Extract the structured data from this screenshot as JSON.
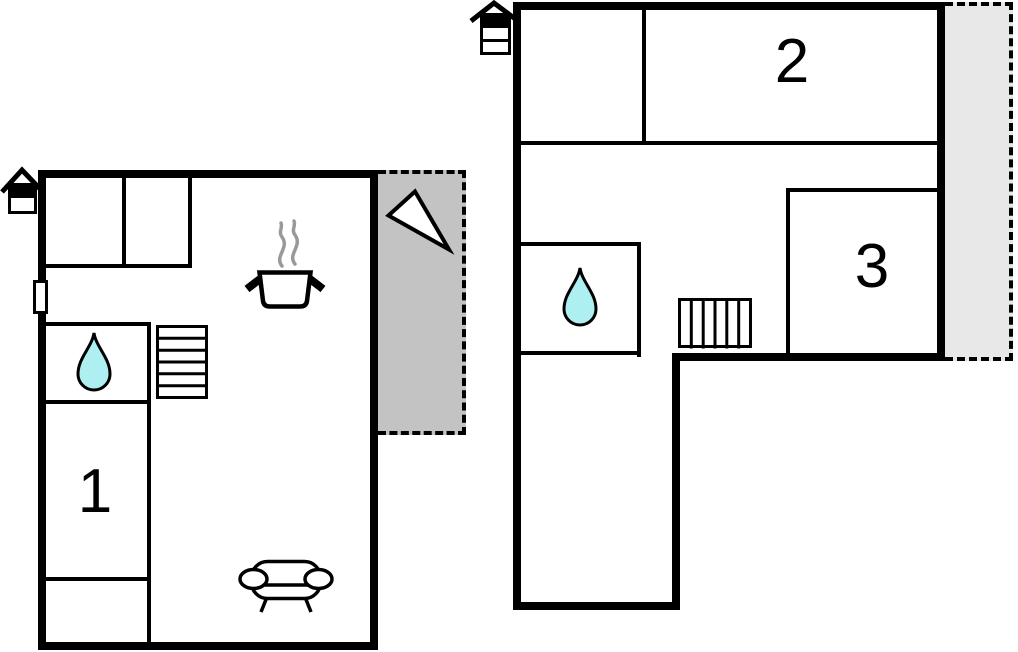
{
  "canvas": {
    "width": 1018,
    "height": 652
  },
  "colors": {
    "wall": "#000000",
    "terrace_left_fill": "#c3c3c3",
    "terrace_right_fill": "#e8e8e8",
    "water_drop_fill": "#aeeff1",
    "steam_stroke": "#999999"
  },
  "ground_floor": {
    "room_labels": [
      {
        "label": "1"
      }
    ],
    "icons": [
      "house-entrance-icon",
      "door-marker",
      "water-drop-icon",
      "stairs-icon",
      "cooking-pot-icon",
      "sofa-icon",
      "north-arrow-icon"
    ]
  },
  "upper_floor": {
    "room_labels": [
      {
        "label": "2"
      },
      {
        "label": "3"
      }
    ],
    "icons": [
      "house-entrance-icon",
      "water-drop-icon",
      "stairs-icon"
    ]
  }
}
